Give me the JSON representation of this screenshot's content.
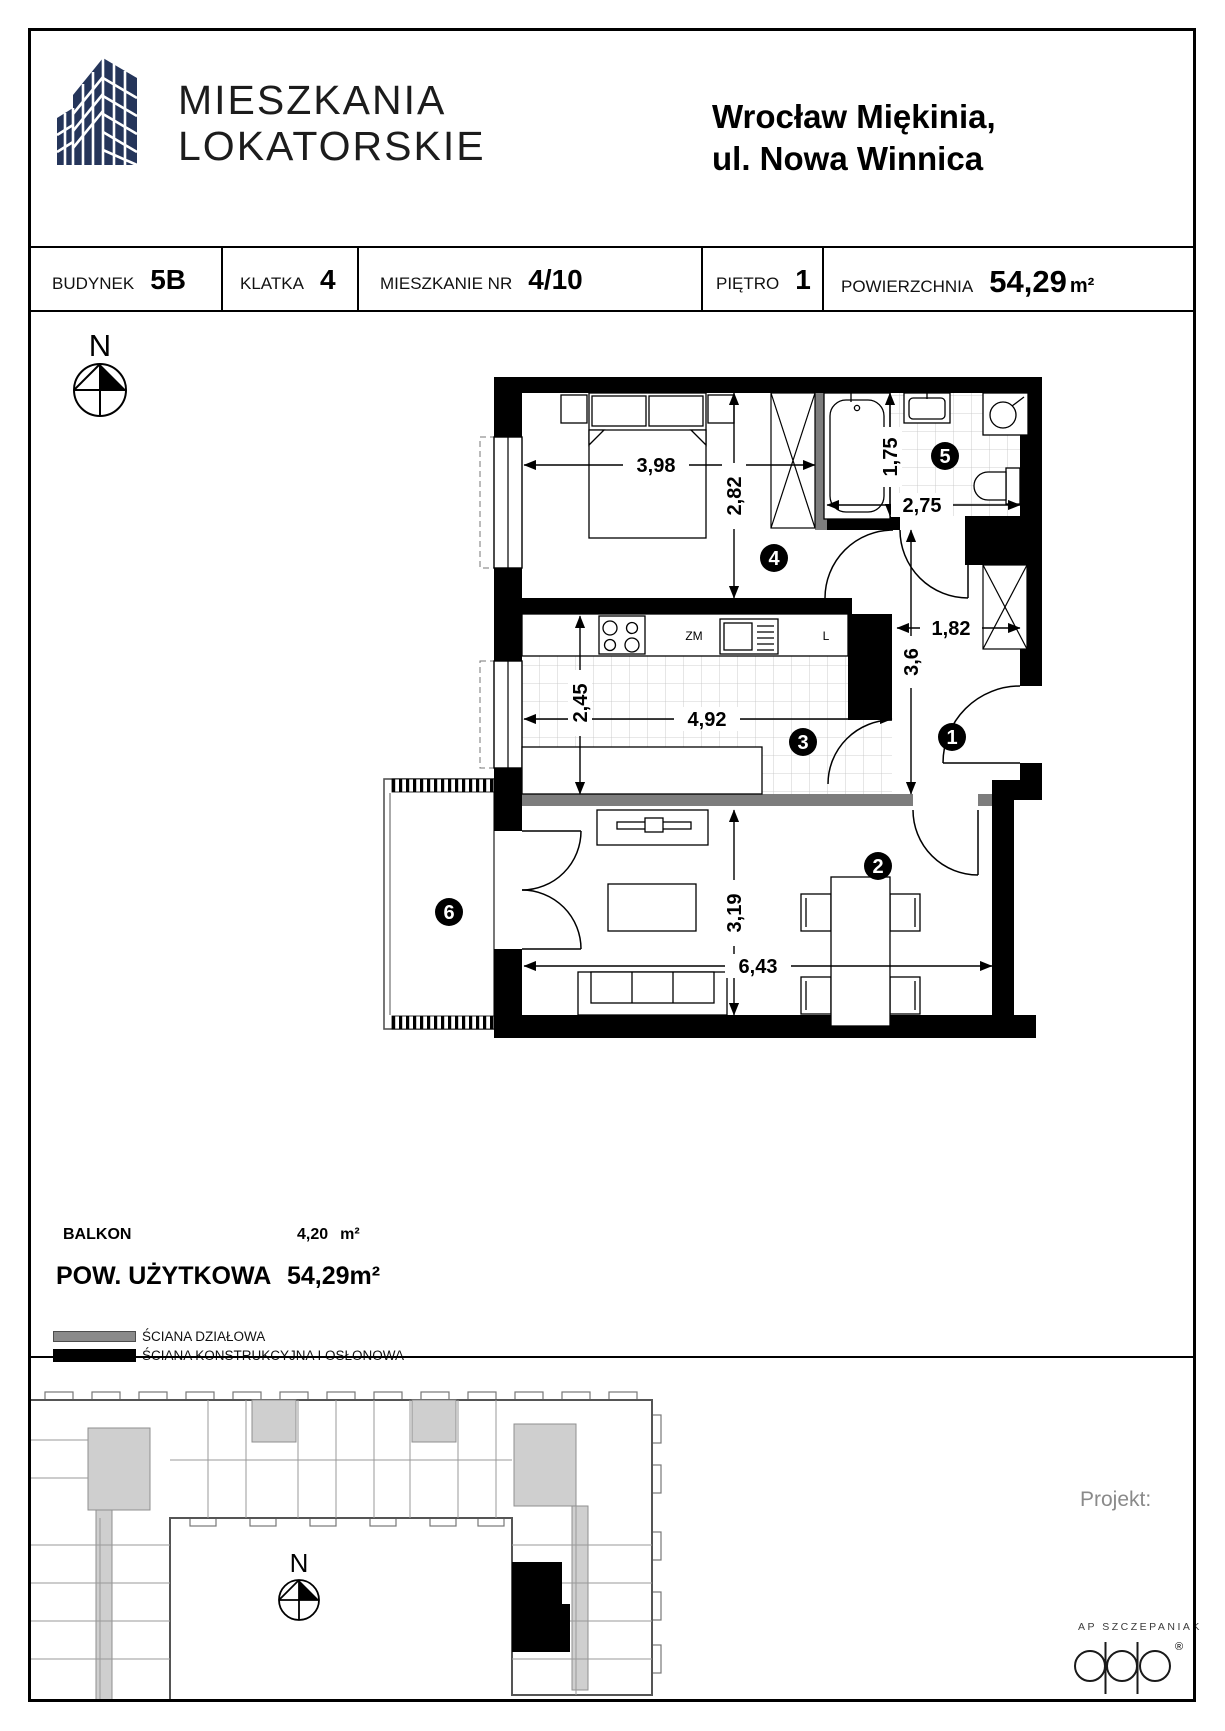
{
  "header": {
    "brand_line1": "MIESZKANIA",
    "brand_line2": "LOKATORSKIE",
    "title_line1": "Wrocław Miękinia,",
    "title_line2": "ul. Nowa Winnica"
  },
  "info_bar": {
    "cells": [
      {
        "label": "BUDYNEK",
        "value": "5B"
      },
      {
        "label": "KLATKA",
        "value": "4"
      },
      {
        "label": "MIESZKANIE NR",
        "value": "4/10"
      },
      {
        "label": "PIĘTRO",
        "value": "1"
      },
      {
        "label": "POWIERZCHNIA",
        "value": "54,29",
        "unit": "m²"
      }
    ]
  },
  "plan": {
    "compass_n": "N",
    "room_numbers": {
      "r1": "1",
      "r2": "2",
      "r3": "3",
      "r4": "4",
      "r5": "5",
      "r6": "6"
    },
    "dims": {
      "bedroom_width": "3,98",
      "bedroom_height": "2,82",
      "bath_height": "1,75",
      "bath_width": "2,75",
      "hall_width": "1,82",
      "hall_height": "3,6",
      "kitchen_height": "2,45",
      "kitchen_width": "4,92",
      "living_height": "3,19",
      "living_width": "6,43"
    },
    "labels": {
      "dishwasher": "ZM",
      "fridge": "L"
    }
  },
  "summary": {
    "balcony_label": "BALKON",
    "balcony_value": "4,20",
    "balcony_unit": "m²",
    "area_label": "POW. UŻYTKOWA",
    "area_value": "54,29m²"
  },
  "legend": {
    "partition_wall": "ŚCIANA DZIAŁOWA",
    "structural_wall": "ŚCIANA KONSTRUKCYJNA I OSŁONOWA"
  },
  "site_plan": {
    "compass_n": "N"
  },
  "footer": {
    "project_label": "Projekt:",
    "studio_name": "AP SZCZEPANIAK",
    "registered_mark": "®"
  },
  "colors": {
    "brand_navy": "#25355a",
    "wall_black": "#000000",
    "wall_gray": "#7d7d7d"
  }
}
